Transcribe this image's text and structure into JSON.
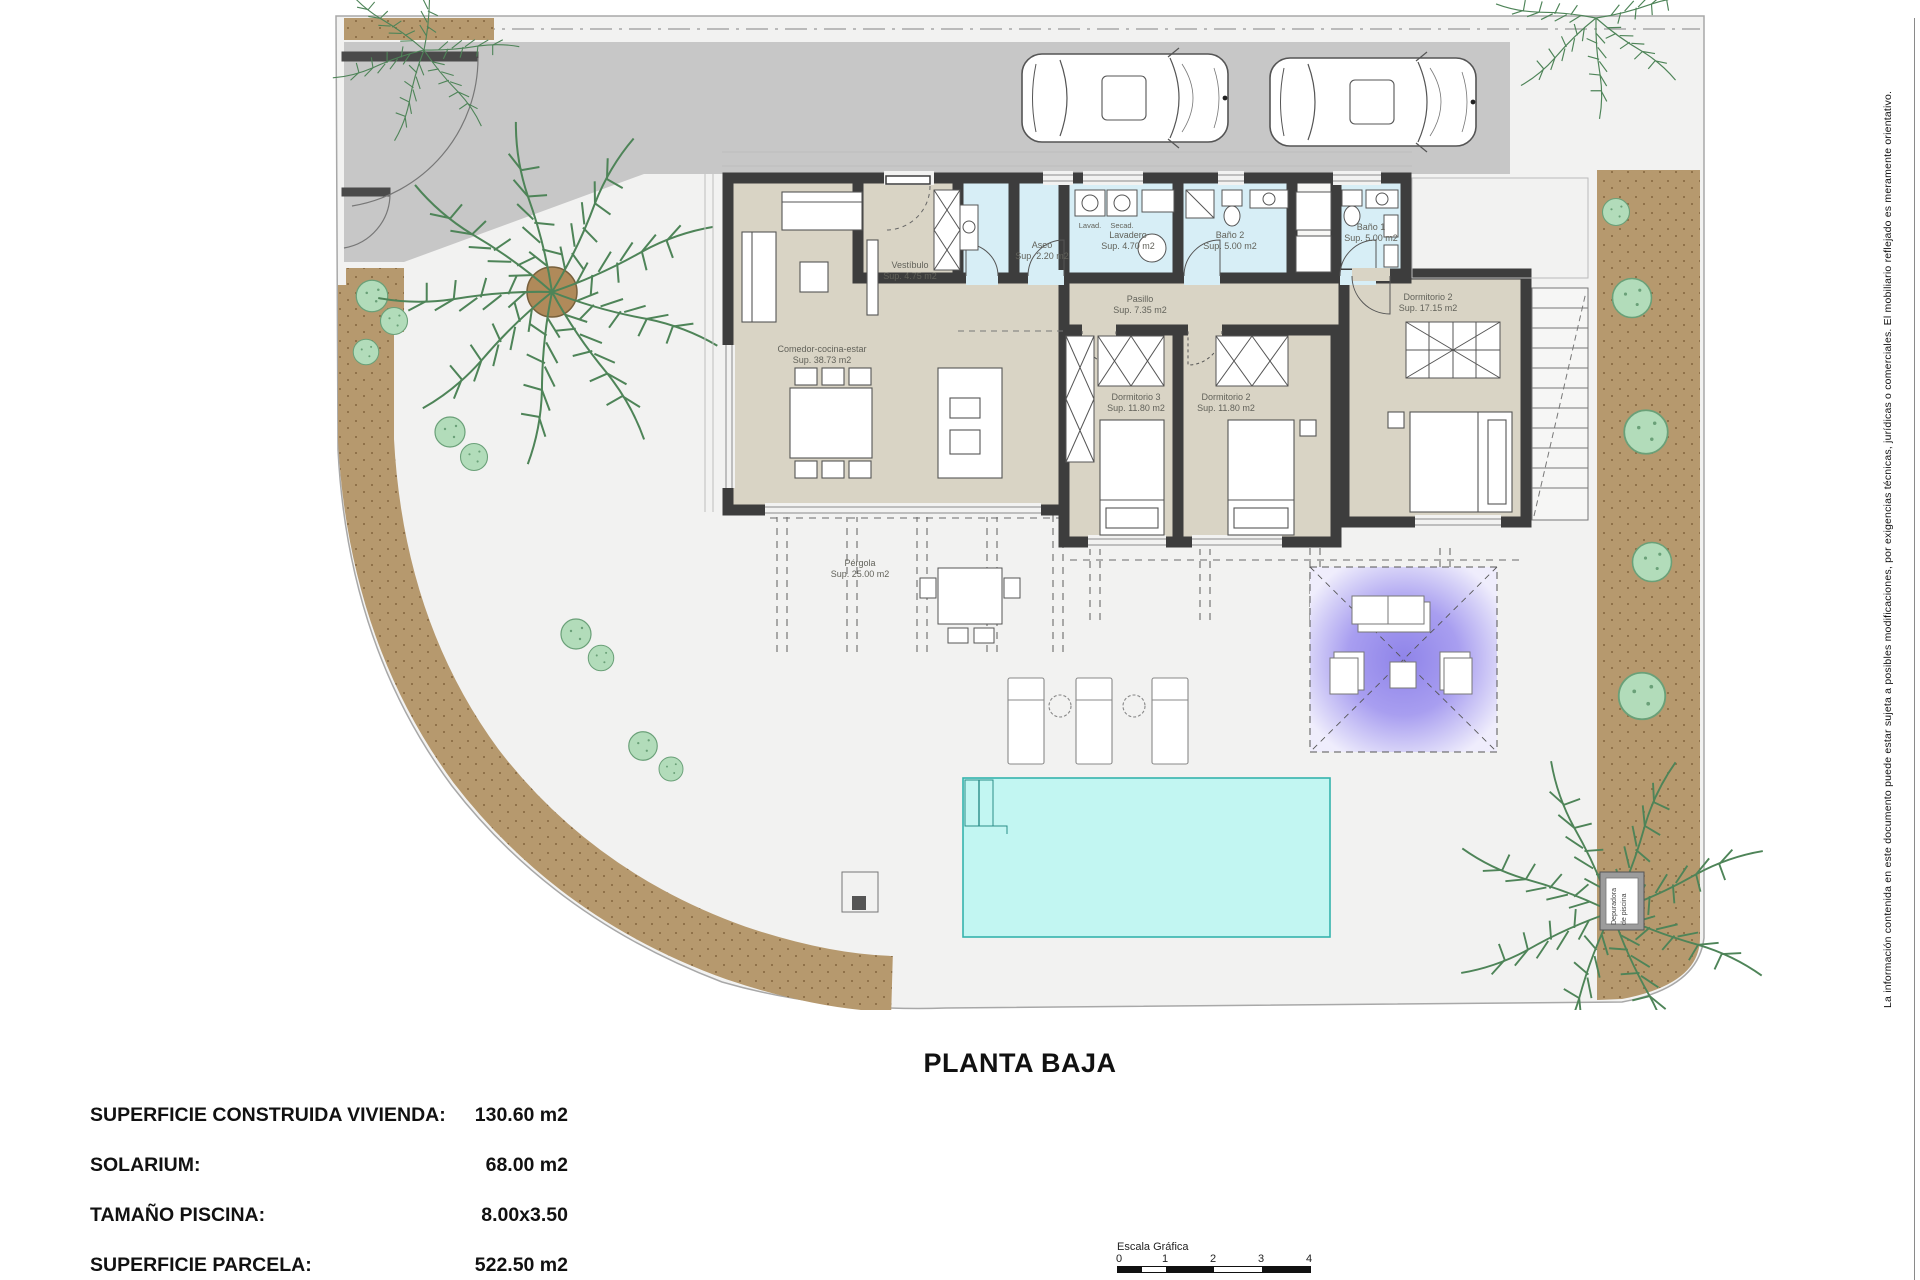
{
  "title": "PLANTA BAJA",
  "summary": {
    "rows": [
      {
        "label": "SUPERFICIE CONSTRUIDA VIVIENDA:",
        "value": "130.60 m2"
      },
      {
        "label": "SOLARIUM:",
        "value": "68.00 m2"
      },
      {
        "label": "TAMAÑO PISCINA:",
        "value": "8.00x3.50"
      },
      {
        "label": "SUPERFICIE PARCELA:",
        "value": "522.50 m2"
      }
    ]
  },
  "rooms": {
    "comedor": {
      "name": "Comedor-cocina-estar",
      "area": "Sup. 38.73 m2"
    },
    "vestibulo": {
      "name": "Vestíbulo",
      "area": "Sup. 4.75 m2"
    },
    "aseo": {
      "name": "Aseo",
      "area": "Sup. 2.20 m2"
    },
    "lavadero": {
      "name": "Lavadero",
      "area": "Sup. 4.70 m2"
    },
    "bano2": {
      "name": "Baño 2",
      "area": "Sup. 5.00 m2"
    },
    "bano1": {
      "name": "Baño 1",
      "area": "Sup. 5.00 m2"
    },
    "pasillo": {
      "name": "Pasillo",
      "area": "Sup. 7.35 m2"
    },
    "dorm3": {
      "name": "Dormitorio 3",
      "area": "Sup. 11.80 m2"
    },
    "dorm2": {
      "name": "Dormitorio 2",
      "area": "Sup. 11.80 m2"
    },
    "dorm1": {
      "name": "Dormitorio 2",
      "area": "Sup. 17.15 m2"
    },
    "pergola": {
      "name": "Pérgola",
      "area": "Sup. 25.00 m2"
    }
  },
  "appliances": {
    "washer": "Lavad.",
    "dryer": "Secad."
  },
  "equipment": {
    "pool_plant_line1": "Depuradora",
    "pool_plant_line2": "de piscina"
  },
  "scale_bar": {
    "label": "Escala Gráfica",
    "ticks": [
      "0",
      "1",
      "2",
      "3",
      "4"
    ]
  },
  "disclaimer": "La información contenida en este documento puede estar sujeta a posibles modificaciones, por exigencias técnicas, jurídicas o comerciales. El mobiliario reflejado es meramente orientativo.",
  "colors": {
    "driveway": "#c7c7c7",
    "wall": "#3d3d3d",
    "room_beige": "#d9d4c5",
    "room_wet": "#d7eef6",
    "pool": "#c2f6f2",
    "garden_band": "#b6996e",
    "bush": "#b2dcba",
    "solarium_purple": "#8f84e9"
  }
}
